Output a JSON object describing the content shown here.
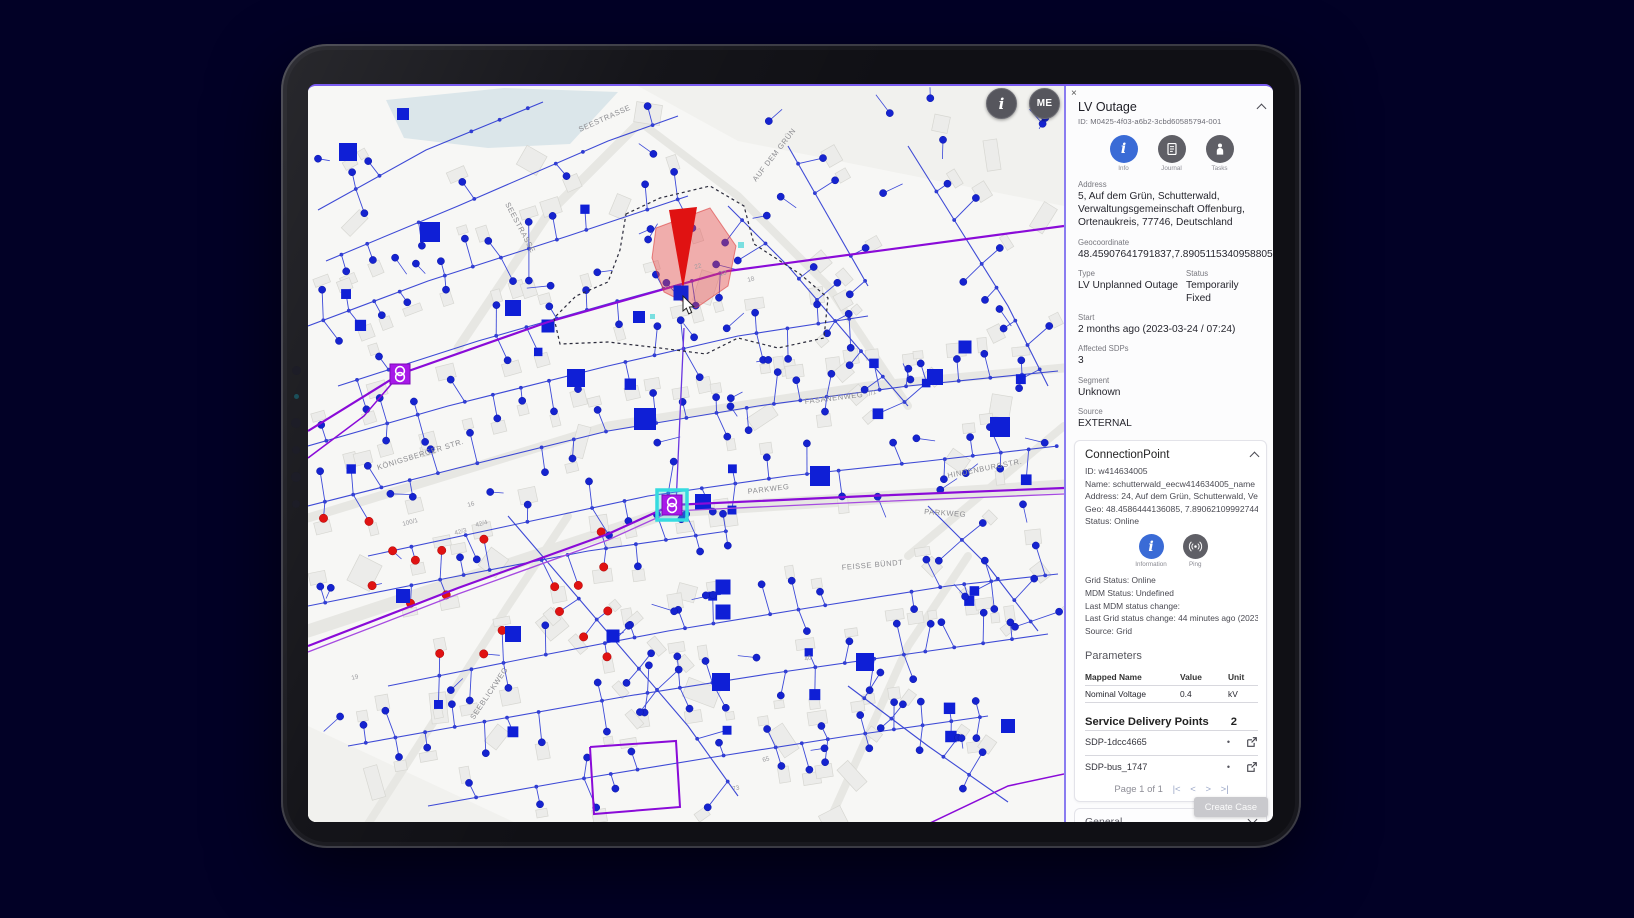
{
  "background": {
    "color": "#020126"
  },
  "map": {
    "controls": {
      "info_button_label": "i",
      "user_button_label": "ME"
    },
    "street_labels": [
      {
        "text": "SEESTRASSE",
        "x": 197,
        "y": 118,
        "rot": 62
      },
      {
        "text": "SEESTRASSE",
        "x": 272,
        "y": 46,
        "rot": -24
      },
      {
        "text": "AUF DEM GRÜN",
        "x": 448,
        "y": 96,
        "rot": -52
      },
      {
        "text": "FASANENWEG",
        "x": 497,
        "y": 318,
        "rot": -7
      },
      {
        "text": "HINDENBURGSTR.",
        "x": 640,
        "y": 392,
        "rot": -11
      },
      {
        "text": "PARKWEG",
        "x": 440,
        "y": 408,
        "rot": -7
      },
      {
        "text": "PARKWEG",
        "x": 616,
        "y": 428,
        "rot": 4
      },
      {
        "text": "FEISSE BÜNDT",
        "x": 534,
        "y": 484,
        "rot": -5
      },
      {
        "text": "KÖNIGSBERGER STR.",
        "x": 70,
        "y": 384,
        "rot": -17
      },
      {
        "text": "SEEBLICKWEG",
        "x": 166,
        "y": 634,
        "rot": -56
      }
    ],
    "house_numbers": [
      {
        "text": "22",
        "x": 387,
        "y": 183
      },
      {
        "text": "23",
        "x": 412,
        "y": 190
      },
      {
        "text": "18",
        "x": 440,
        "y": 196
      },
      {
        "text": "16",
        "x": 160,
        "y": 421
      },
      {
        "text": "100/1",
        "x": 95,
        "y": 440
      },
      {
        "text": "42/3",
        "x": 147,
        "y": 449
      },
      {
        "text": "42/4",
        "x": 168,
        "y": 441
      },
      {
        "text": "19",
        "x": 44,
        "y": 594
      },
      {
        "text": "40",
        "x": 497,
        "y": 575
      },
      {
        "text": "65",
        "x": 455,
        "y": 676
      },
      {
        "text": "73",
        "x": 425,
        "y": 705
      },
      {
        "text": "7/1",
        "x": 560,
        "y": 310
      }
    ],
    "colors": {
      "network_blue": "#1523cf",
      "line_blue": "#2e3bd2",
      "outage_red": "#e01212",
      "mv_purple": "#8a0bd8",
      "station_purple": "#a718e8",
      "selection_cyan": "#35dbe0",
      "water": "#dbe6ea"
    }
  },
  "panel": {
    "close_icon": "×",
    "title": "LV Outage",
    "id_line": "ID: M0425-4f03-a6b2-3cbd60585794-001",
    "actions": [
      {
        "label": "Info"
      },
      {
        "label": "Journal"
      },
      {
        "label": "Tasks"
      }
    ],
    "fields": {
      "address_label": "Address",
      "address_value": "5, Auf dem Grün, Schutterwald, Verwaltungsgemeinschaft Offenburg, Ortenaukreis, 77746, Deutschland",
      "geocoordinate_label": "Geocoordinate",
      "geocoordinate_value": "48.45907641791837,7.8905115340958805",
      "type_label": "Type",
      "type_value": "LV Unplanned Outage",
      "status_label": "Status",
      "status_value": "Temporarily Fixed",
      "start_label": "Start",
      "start_value": "2 months ago (2023-03-24 / 07:24)",
      "affected_label": "Affected SDPs",
      "affected_value": "3",
      "segment_label": "Segment",
      "segment_value": "Unknown",
      "source_label": "Source",
      "source_value": "EXTERNAL"
    },
    "connection_point": {
      "title": "ConnectionPoint",
      "lines": [
        "ID: w414634005",
        "Name: schutterwald_eecw414634005_name",
        "Address: 24, Auf dem Grün, Schutterwald, Verwaltun…",
        "Geo: 48.4586444136085, 7.890621099927445",
        "Status: Online"
      ],
      "actions": [
        {
          "label": "Information"
        },
        {
          "label": "Ping"
        }
      ],
      "status_lines": [
        "Grid Status: Online",
        "MDM Status: Undefined",
        "Last MDM status change:",
        "Last Grid status change: 44 minutes ago (2023-05-31…",
        "Source: Grid"
      ],
      "parameters": {
        "title": "Parameters",
        "columns": [
          "Mapped Name",
          "Value",
          "Unit"
        ],
        "rows": [
          [
            "Nominal Voltage",
            "0.4",
            "kV"
          ]
        ]
      },
      "sdp": {
        "title": "Service Delivery Points",
        "count": "2",
        "status_dot": "•",
        "rows": [
          {
            "name": "SDP-1dcc4665"
          },
          {
            "name": "SDP-bus_1747"
          }
        ],
        "pagination": "Page 1 of 1",
        "pag_first": "|<",
        "pag_prev": "<",
        "pag_next": ">",
        "pag_last": ">|"
      }
    },
    "create_case_label": "Create Case",
    "general_label": "General"
  }
}
